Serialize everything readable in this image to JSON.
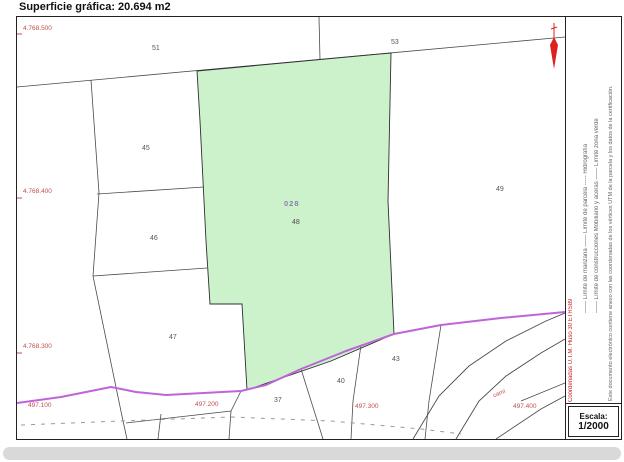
{
  "title": "Superficie gráfica: 20.694 m2",
  "map": {
    "northing_labels": [
      "4.768.500",
      "4.768.400",
      "4.768.300"
    ],
    "easting_labels": [
      "497.100",
      "497.200",
      "497.300",
      "497.400"
    ],
    "parcel_labels": [
      {
        "text": "51",
        "x": 135,
        "y": 28
      },
      {
        "text": "53",
        "x": 374,
        "y": 22
      },
      {
        "text": "45",
        "x": 125,
        "y": 128
      },
      {
        "text": "46",
        "x": 133,
        "y": 218
      },
      {
        "text": "47",
        "x": 152,
        "y": 317
      },
      {
        "text": "49",
        "x": 479,
        "y": 169
      },
      {
        "text": "43",
        "x": 375,
        "y": 339
      },
      {
        "text": "40",
        "x": 320,
        "y": 361
      },
      {
        "text": "37",
        "x": 257,
        "y": 380
      }
    ],
    "highlighted_parcel": {
      "building_code": "028",
      "parcel_number": "48"
    },
    "road_label": "camí"
  },
  "legend": {
    "column1": "—— Límite de manzana      —— Límite de parcela      ----- Hidrografía",
    "column2": "—— Límite de construcciones      Mobiliario y aceras      —— Límite zona verde",
    "coordinates_note": "Coordenadas U.T.M. Huso 30 ETRS89",
    "certification_note": "Este documento electrónico contiene anexo con las coordenadas de los vértices UTM de la parcela y los datos de la certificación."
  },
  "scale": {
    "label": "Escala:",
    "value": "1/2000"
  },
  "colors": {
    "highlight_fill": "#ccf2cb",
    "boundary_line": "#4a4a4a",
    "hydro_line": "#bf64d9",
    "coordinate_text": "#c0504d",
    "north_arrow": "#d22"
  }
}
